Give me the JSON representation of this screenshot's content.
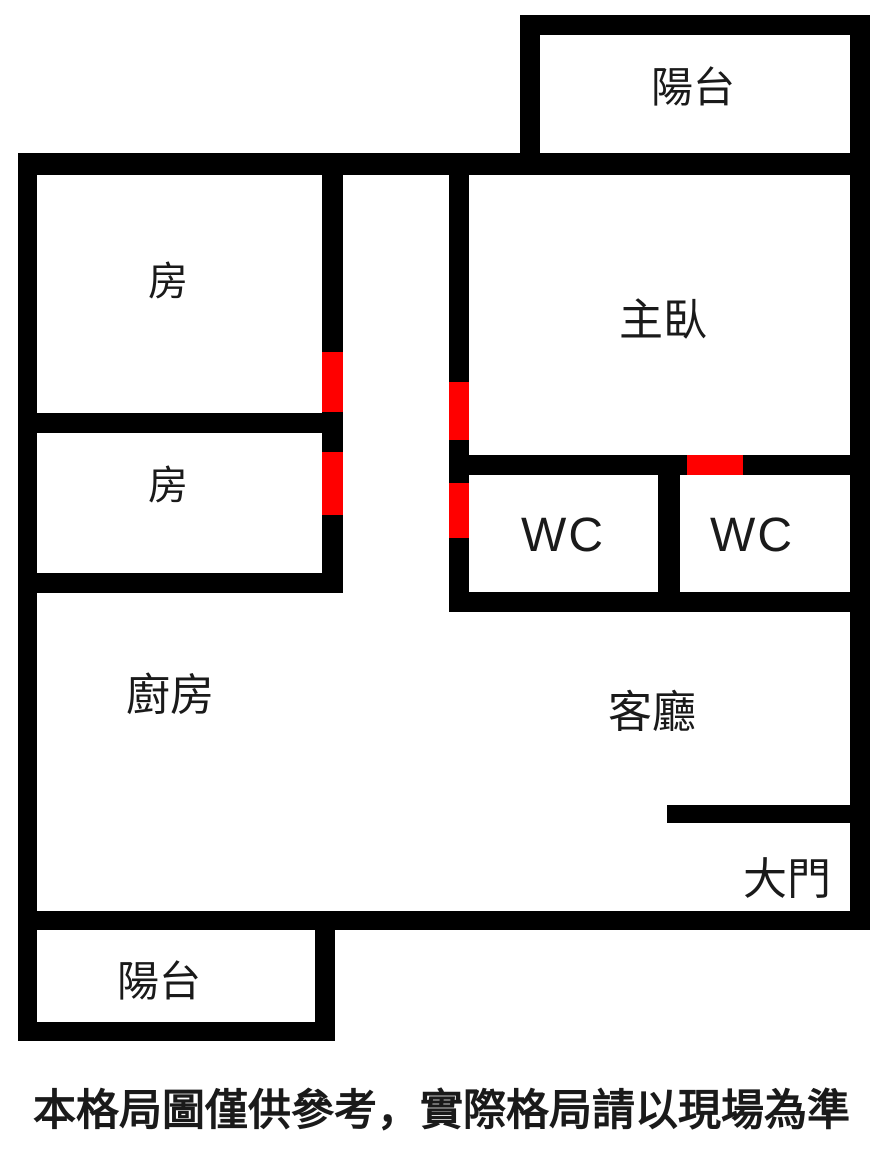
{
  "colors": {
    "wall": "#000000",
    "door": "#ff0000",
    "background": "#ffffff",
    "text": "#1a1a1a"
  },
  "rooms": [
    {
      "id": "balcony-top",
      "label": "陽台"
    },
    {
      "id": "bedroom-1",
      "label": "房"
    },
    {
      "id": "bedroom-2",
      "label": "房"
    },
    {
      "id": "master-bedroom",
      "label": "主臥"
    },
    {
      "id": "wc-1",
      "label": "WC"
    },
    {
      "id": "wc-2",
      "label": "WC"
    },
    {
      "id": "kitchen",
      "label": "廚房"
    },
    {
      "id": "living-room",
      "label": "客廳"
    },
    {
      "id": "main-door",
      "label": "大門"
    },
    {
      "id": "balcony-bottom",
      "label": "陽台"
    }
  ],
  "disclaimer": "本格局圖僅供參考，實際格局請以現場為準"
}
